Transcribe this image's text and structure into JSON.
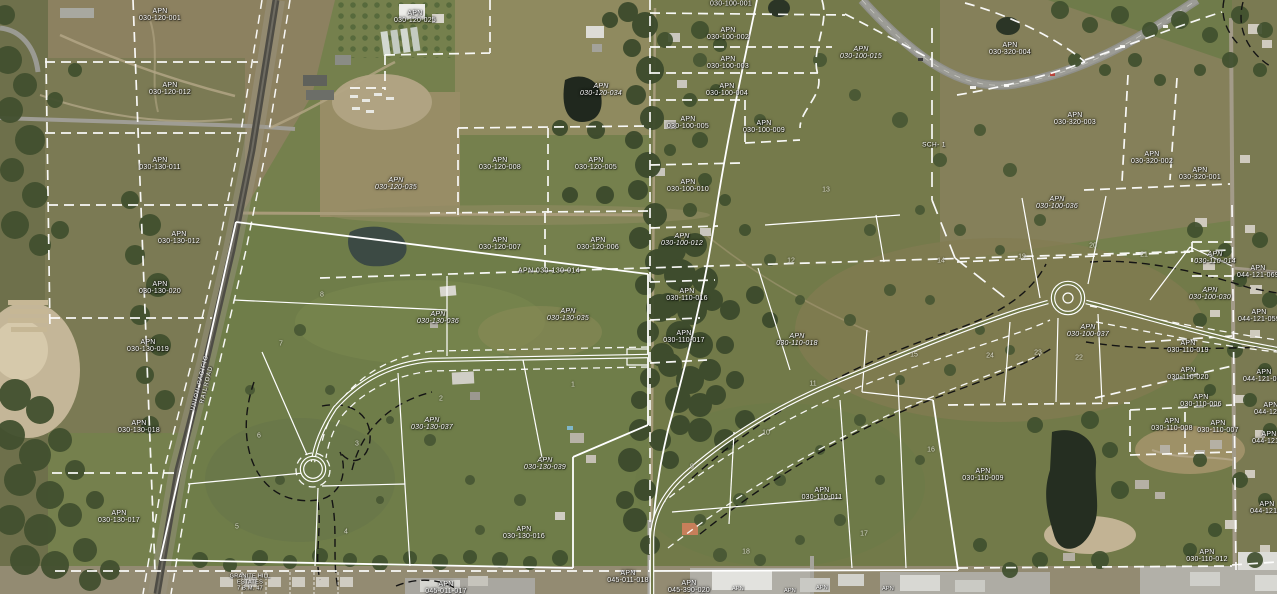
{
  "map": {
    "apn_prefix": "APN",
    "colors": {
      "parcel_boundary": "#ffffff",
      "easement_line": "#141414",
      "label_text": "#ffffff"
    },
    "apn_labels": [
      {
        "apn": "030-120-001",
        "x": 160,
        "y": 15
      },
      {
        "apn": "030-120-025",
        "x": 415,
        "y": 17
      },
      {
        "apn": "030-120-012",
        "x": 170,
        "y": 89
      },
      {
        "apn": "030-120-034",
        "x": 601,
        "y": 90,
        "italic": true
      },
      {
        "apn": "030-130-011",
        "x": 160,
        "y": 164
      },
      {
        "apn": "030-120-008",
        "x": 500,
        "y": 164
      },
      {
        "apn": "030-120-005",
        "x": 596,
        "y": 164
      },
      {
        "apn": "030-120-035",
        "x": 396,
        "y": 184,
        "italic": true
      },
      {
        "apn": "030-130-012",
        "x": 179,
        "y": 238
      },
      {
        "apn": "030-120-007",
        "x": 500,
        "y": 244
      },
      {
        "apn": "030-120-006",
        "x": 598,
        "y": 244
      },
      {
        "apn": "030-130-020",
        "x": 160,
        "y": 288
      },
      {
        "apn": "030-130-019",
        "x": 148,
        "y": 346
      },
      {
        "apn": "030-130-018",
        "x": 139,
        "y": 427
      },
      {
        "apn": "030-130-017",
        "x": 119,
        "y": 517
      },
      {
        "apn": "030-100-001",
        "x": 731,
        "y": 4,
        "single_line": true
      },
      {
        "apn": "030-100-002",
        "x": 728,
        "y": 34
      },
      {
        "apn": "030-100-003",
        "x": 728,
        "y": 63
      },
      {
        "apn": "030-100-004",
        "x": 727,
        "y": 90
      },
      {
        "apn": "030-100-005",
        "x": 688,
        "y": 123
      },
      {
        "apn": "030-100-009",
        "x": 764,
        "y": 127
      },
      {
        "apn": "030-100-015",
        "x": 861,
        "y": 53,
        "italic": true
      },
      {
        "apn": "030-100-010",
        "x": 688,
        "y": 186
      },
      {
        "apn": "030-100-012",
        "x": 682,
        "y": 240,
        "italic": true
      },
      {
        "apn": "030-110-016",
        "x": 687,
        "y": 295
      },
      {
        "apn": "030-110-017",
        "x": 684,
        "y": 337
      },
      {
        "apn": "030-110-018",
        "x": 797,
        "y": 340,
        "italic": true
      },
      {
        "apn": "030-110-011",
        "x": 822,
        "y": 494
      },
      {
        "apn": "030-110-009",
        "x": 983,
        "y": 475
      },
      {
        "apn": "030-320-004",
        "x": 1010,
        "y": 49
      },
      {
        "apn": "030-320-003",
        "x": 1075,
        "y": 119
      },
      {
        "apn": "030-320-002",
        "x": 1152,
        "y": 158
      },
      {
        "apn": "030-320-001",
        "x": 1200,
        "y": 174
      },
      {
        "apn": "030-100-036",
        "x": 1057,
        "y": 203,
        "italic": true
      },
      {
        "apn": "030-110-014",
        "x": 1215,
        "y": 258,
        "italic": true
      },
      {
        "apn": "044-121-069",
        "x": 1258,
        "y": 272
      },
      {
        "apn": "030-100-030",
        "x": 1210,
        "y": 294,
        "italic": true
      },
      {
        "apn": "044-121-059",
        "x": 1259,
        "y": 316
      },
      {
        "apn": "030-100-037",
        "x": 1088,
        "y": 331,
        "italic": true
      },
      {
        "apn": "030-110-019",
        "x": 1188,
        "y": 347
      },
      {
        "apn": "030-110-020",
        "x": 1188,
        "y": 374
      },
      {
        "apn": "044-121-066",
        "x": 1264,
        "y": 376
      },
      {
        "apn": "030-110-006",
        "x": 1201,
        "y": 401
      },
      {
        "apn": "044-121-0",
        "x": 1271,
        "y": 409
      },
      {
        "apn": "030-110-008",
        "x": 1172,
        "y": 425
      },
      {
        "apn": "030-110-007",
        "x": 1218,
        "y": 427
      },
      {
        "apn": "044-121-0",
        "x": 1269,
        "y": 438
      },
      {
        "apn": "044-121-0",
        "x": 1267,
        "y": 508
      },
      {
        "apn": "030-110-012",
        "x": 1207,
        "y": 556
      },
      {
        "apn": "030-130-036",
        "x": 438,
        "y": 318,
        "italic": true
      },
      {
        "apn": "030-130-035",
        "x": 568,
        "y": 315,
        "italic": true
      },
      {
        "apn": "030-130-037",
        "x": 432,
        "y": 424,
        "italic": true
      },
      {
        "apn": "030-130-039",
        "x": 545,
        "y": 464,
        "italic": true
      },
      {
        "apn": "030-130-016",
        "x": 524,
        "y": 533
      },
      {
        "apn": "045-011-017",
        "x": 446,
        "y": 588
      },
      {
        "apn": "045-011-018",
        "x": 628,
        "y": 577
      },
      {
        "apn": "045-390-020",
        "x": 689,
        "y": 587
      }
    ],
    "lot_numbers": [
      {
        "n": "1",
        "x": 573,
        "y": 385
      },
      {
        "n": "2",
        "x": 441,
        "y": 399
      },
      {
        "n": "3",
        "x": 357,
        "y": 444
      },
      {
        "n": "4",
        "x": 346,
        "y": 532
      },
      {
        "n": "5",
        "x": 237,
        "y": 527
      },
      {
        "n": "6",
        "x": 259,
        "y": 436
      },
      {
        "n": "7",
        "x": 281,
        "y": 344
      },
      {
        "n": "8",
        "x": 322,
        "y": 295
      },
      {
        "n": "9",
        "x": 692,
        "y": 467
      },
      {
        "n": "10",
        "x": 766,
        "y": 433
      },
      {
        "n": "11",
        "x": 813,
        "y": 384
      },
      {
        "n": "12",
        "x": 791,
        "y": 261
      },
      {
        "n": "13",
        "x": 826,
        "y": 190
      },
      {
        "n": "14",
        "x": 941,
        "y": 261
      },
      {
        "n": "15",
        "x": 914,
        "y": 355
      },
      {
        "n": "16",
        "x": 931,
        "y": 450
      },
      {
        "n": "17",
        "x": 864,
        "y": 534
      },
      {
        "n": "18",
        "x": 746,
        "y": 552
      },
      {
        "n": "19",
        "x": 1022,
        "y": 257
      },
      {
        "n": "20",
        "x": 1093,
        "y": 246
      },
      {
        "n": "21",
        "x": 1144,
        "y": 255
      },
      {
        "n": "22",
        "x": 1079,
        "y": 358
      },
      {
        "n": "23",
        "x": 1038,
        "y": 353
      },
      {
        "n": "24",
        "x": 990,
        "y": 356
      }
    ],
    "misc_labels": [
      {
        "id": "railroad-name",
        "lines": [
          "UNION PACIFIC",
          "RAILROAD"
        ],
        "x": 204,
        "y": 384,
        "rotate": -76,
        "cls": "rr"
      },
      {
        "id": "school-site",
        "lines": [
          "SCH- 1"
        ],
        "x": 934,
        "y": 145,
        "cls": ""
      },
      {
        "id": "subdivision-name",
        "lines": [
          "GRANITE HILL",
          "ESTATES",
          "7 B.M. 47"
        ],
        "x": 250,
        "y": 583,
        "cls": "tiny"
      },
      {
        "id": "line-label",
        "lines": [
          "APN  030-130-014"
        ],
        "x": 549,
        "y": 271,
        "cls": "inline-apn"
      },
      {
        "id": "apn-stub",
        "lines": [
          "APN"
        ],
        "x": 738,
        "y": 589,
        "cls": "tiny"
      },
      {
        "id": "apn-stub",
        "lines": [
          "APN"
        ],
        "x": 790,
        "y": 591,
        "cls": "tiny"
      },
      {
        "id": "apn-stub",
        "lines": [
          "APN"
        ],
        "x": 822,
        "y": 588,
        "cls": "tiny"
      },
      {
        "id": "apn-stub",
        "lines": [
          "APN"
        ],
        "x": 888,
        "y": 589,
        "cls": "tiny"
      }
    ]
  }
}
